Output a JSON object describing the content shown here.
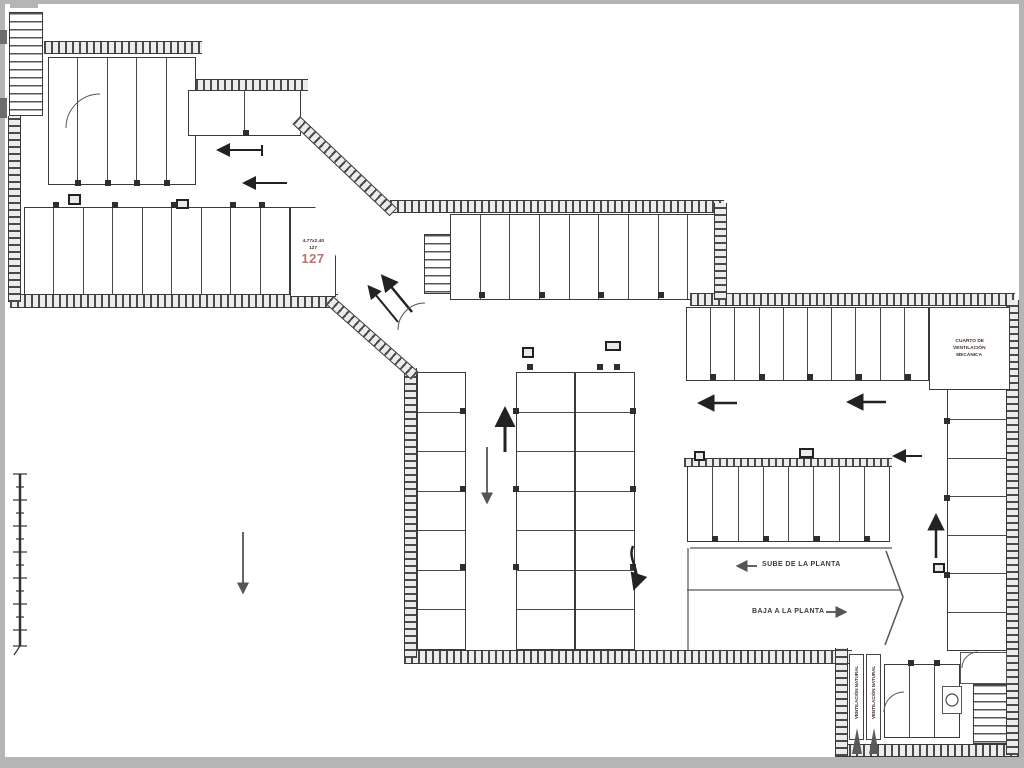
{
  "colors": {
    "stall_number": "#b2655c",
    "label_text": "#41302b",
    "wall": "#3a3a3a"
  },
  "groups": {
    "g117": {
      "stalls": [
        {
          "n": "117",
          "d": "5.00x2.50"
        },
        {
          "n": "116",
          "d": "5.00x2.50"
        },
        {
          "n": "115",
          "d": "5.00x2.50"
        },
        {
          "n": "114",
          "d": "5.00x2.50"
        },
        {
          "n": "113",
          "d": "5.00x2.50"
        }
      ]
    },
    "g112": {
      "stalls": [
        {
          "n": "112",
          "d": "5.15x2.40"
        },
        {
          "n": "111",
          "d": "5.04x2.40"
        }
      ]
    },
    "g118": {
      "stalls": [
        {
          "n": "118",
          "d": "5.00x2.50"
        },
        {
          "n": "119",
          "d": "5.00x2.50"
        },
        {
          "n": "120",
          "d": "5.00x2.50"
        },
        {
          "n": "121",
          "d": "5.00x2.50"
        },
        {
          "n": "122",
          "d": "5.00x2.50"
        },
        {
          "n": "123",
          "d": "5.00x2.50"
        },
        {
          "n": "124",
          "d": "5.00x2.50"
        },
        {
          "n": "125",
          "d": "5.00x2.50"
        },
        {
          "n": "126",
          "d": "5.00x2.50"
        }
      ]
    },
    "g127": {
      "stalls": [
        {
          "n": "127",
          "d": "4.77x2.40"
        }
      ]
    },
    "g110": {
      "stalls": [
        {
          "n": "110",
          "d": "4.79x2.40"
        },
        {
          "n": "109",
          "d": "4.79x2.40"
        },
        {
          "n": "108",
          "d": "4.79x2.40"
        },
        {
          "n": "107",
          "d": "4.79x2.40"
        },
        {
          "n": "106",
          "d": "4.79x2.40"
        },
        {
          "n": "105",
          "d": "4.79x2.40"
        },
        {
          "n": "104",
          "d": "4.79x2.40"
        },
        {
          "n": "103",
          "d": "4.79x2.40"
        },
        {
          "n": "102",
          "d": "4.79x2.40"
        }
      ]
    },
    "g101": {
      "stalls": [
        {
          "n": "101",
          "d": "4.79x2.40"
        },
        {
          "n": "100",
          "d": "4.79x2.40"
        },
        {
          "n": "99",
          "d": "4.79x2.40"
        },
        {
          "n": "98",
          "d": "4.79x2.40"
        },
        {
          "n": "97",
          "d": "4.79x2.40"
        },
        {
          "n": "96",
          "d": "4.79x2.40"
        },
        {
          "n": "95",
          "d": "4.79x2.40"
        },
        {
          "n": "94",
          "d": "4.79x2.40"
        },
        {
          "n": "93",
          "d": "4.79x2.40"
        },
        {
          "n": "92",
          "d": "4.79x2.40"
        }
      ]
    },
    "g128": {
      "stalls": [
        {
          "n": "128",
          "d": "4.79x2.40"
        },
        {
          "n": "129",
          "d": "4.79x2.40"
        },
        {
          "n": "130",
          "d": "4.79x2.40"
        },
        {
          "n": "131",
          "d": "4.79x2.40"
        },
        {
          "n": "132",
          "d": "4.79x2.40"
        },
        {
          "n": "133",
          "d": "4.79x2.40"
        },
        {
          "n": "134",
          "d": "4.79x2.40"
        }
      ]
    },
    "gmidc": {
      "stalls": [
        {
          "n": "141",
          "d": "4.79x2.40"
        },
        {
          "n": "140",
          "d": "4.79x2.40"
        },
        {
          "n": "139",
          "d": "4.79x2.40"
        },
        {
          "n": "138",
          "d": "4.79x2.40"
        },
        {
          "n": "137",
          "d": "4.79x2.40"
        },
        {
          "n": "136",
          "d": "4.79x2.40"
        },
        {
          "n": "135",
          "d": "4.79x2.40"
        }
      ]
    },
    "gmidr": {
      "stalls": [
        {
          "n": "142",
          "d": "4.79x2.40"
        },
        {
          "n": "143",
          "d": "4.79x2.40"
        },
        {
          "n": "144",
          "d": "4.79x2.40"
        },
        {
          "n": "145",
          "d": "4.79x2.40"
        },
        {
          "n": "146",
          "d": "4.79x2.40"
        },
        {
          "n": "147",
          "d": "4.79x2.40"
        },
        {
          "n": "148",
          "d": "4.79x2.40"
        }
      ]
    },
    "g74": {
      "stalls": [
        {
          "n": "74",
          "d": "4.70x2.30"
        },
        {
          "n": "75",
          "d": "4.70x2.30"
        },
        {
          "n": "76",
          "d": "4.70x2.30"
        },
        {
          "n": "77",
          "d": "4.70x2.30"
        },
        {
          "n": "78",
          "d": "4.70x2.30"
        },
        {
          "n": "79",
          "d": "4.70x2.30"
        },
        {
          "n": "80",
          "d": "4.70x2.30"
        },
        {
          "n": "81",
          "d": "4.70x2.30"
        }
      ]
    },
    "g91": {
      "stalls": [
        {
          "n": "91",
          "d": "4.70x2.40"
        },
        {
          "n": "90",
          "d": "4.70x2.40"
        },
        {
          "n": "89",
          "d": "4.70x2.40"
        },
        {
          "n": "88",
          "d": "4.70x2.40"
        },
        {
          "n": "87",
          "d": "4.70x2.40"
        },
        {
          "n": "86",
          "d": "4.70x2.40"
        },
        {
          "n": "85",
          "d": "4.70x2.40"
        }
      ]
    },
    "g82": {
      "stalls": [
        {
          "n": "82",
          "d": "4.70x2.30"
        },
        {
          "n": "83",
          "d": "4.70x2.30"
        },
        {
          "n": "84",
          "d": "4.70x2.30"
        }
      ]
    }
  },
  "labels": {
    "vent_room_line1": "CUARTO DE",
    "vent_room_line2": "VENTILACIÓN",
    "vent_room_line3": "MECÁNICA",
    "ramp_up": "SUBE DE LA PLANTA",
    "ramp_down": "BAJA A LA PLANTA",
    "shaft_left": "VENTILACIÓN NATURAL",
    "shaft_right": "VENTILACIÓN NATURAL"
  }
}
